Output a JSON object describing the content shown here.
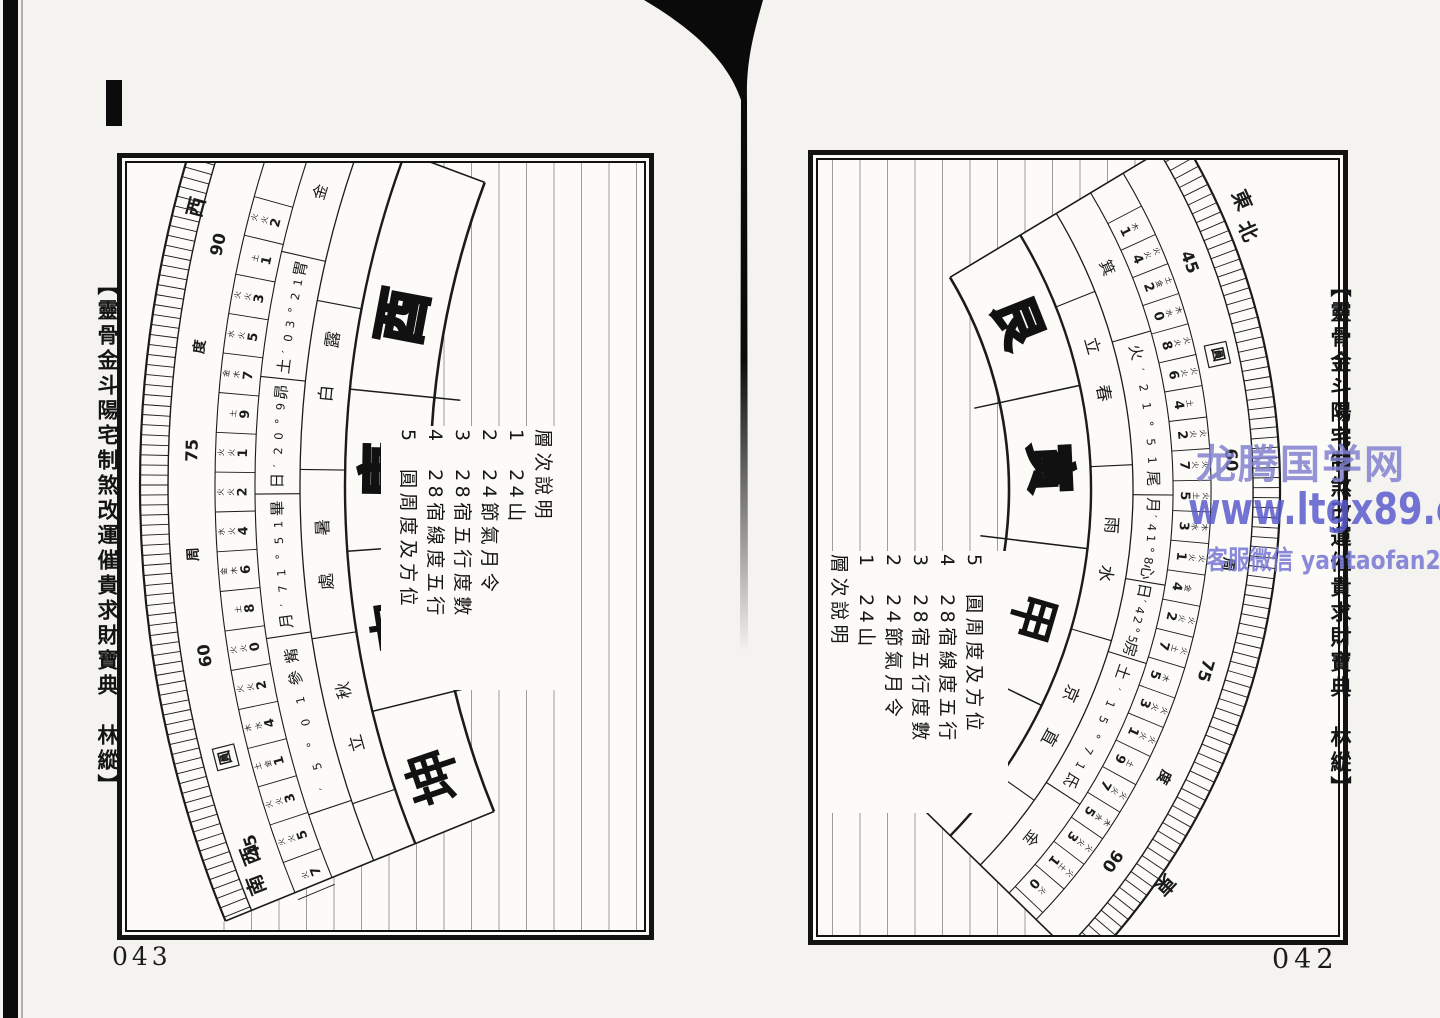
{
  "watermark": {
    "line1": "龙腾国学网",
    "line2": "www.ltgx89.com",
    "line3": "客服微信 yantaofan225",
    "color": "#6c6cc8"
  },
  "pages": [
    {
      "id": "left",
      "page_number": "043",
      "margin_title": "【靈骨金斗陽宅制煞改運催貴求財寶典　林縱】",
      "legend": {
        "title": "層次說明",
        "items": [
          "1　24山",
          "2　24節氣月令",
          "3　28宿五行度數",
          "4　28宿線度五行",
          "5　圓周度及方位"
        ]
      },
      "compass": {
        "direction_labels": [
          "西",
          "西南"
        ],
        "degree_ring": [
          "90",
          "度",
          "75",
          "周",
          "60",
          "圓",
          "45"
        ],
        "boxed_label": "圓",
        "mountains": [
          {
            "name": "酉",
            "style": "outline"
          },
          {
            "name": "庚",
            "style": "outline"
          },
          {
            "name": "申",
            "style": "solid"
          },
          {
            "name": "坤",
            "style": "solid"
          }
        ],
        "solar_terms": [
          {
            "upper": "露",
            "lower": "白"
          },
          {
            "upper": "暑",
            "lower": "處"
          },
          {
            "upper": "秋",
            "lower": "立"
          }
        ],
        "mansions": [
          "金",
          "胃12°30′土",
          "昴9°02′日",
          "畢15°17′月",
          "觜參10°5′"
        ],
        "line_degrees": [
          {
            "n": "2",
            "e": "火火"
          },
          {
            "n": "1",
            "e": "土"
          },
          {
            "n": "3",
            "e": "火火"
          },
          {
            "n": "5",
            "e": "火水"
          },
          {
            "n": "7",
            "e": "木金"
          },
          {
            "n": "9",
            "e": "土"
          },
          {
            "n": "1",
            "e": "火火"
          },
          {
            "n": "2",
            "e": "火火"
          },
          {
            "n": "4",
            "e": "火水"
          },
          {
            "n": "6",
            "e": "木金"
          },
          {
            "n": "8",
            "e": "土"
          },
          {
            "n": "0",
            "e": "火火"
          },
          {
            "n": "2",
            "e": "火火"
          },
          {
            "n": "4",
            "e": "水木"
          },
          {
            "n": "1",
            "e": "金土"
          },
          {
            "n": "3",
            "e": "火火"
          },
          {
            "n": "5",
            "e": "火火"
          },
          {
            "n": "7",
            "e": "火"
          }
        ]
      }
    },
    {
      "id": "right",
      "page_number": "042",
      "margin_title": "【靈骨金斗陽宅制煞改運催貴求財寶典　林縱】",
      "legend": {
        "title": "層次說明",
        "items": [
          "1　24山",
          "2　24節氣月令",
          "3　28宿五行度數",
          "4　28宿線度五行",
          "5　圓周度及方位"
        ]
      },
      "compass": {
        "direction_labels": [
          "東北",
          "東"
        ],
        "degree_ring": [
          "45",
          "圓",
          "60",
          "周",
          "75",
          "度",
          "90"
        ],
        "boxed_label": "圓",
        "mountains": [
          {
            "name": "艮",
            "style": "outline"
          },
          {
            "name": "寅",
            "style": "outline"
          },
          {
            "name": "甲",
            "style": "solid"
          },
          {
            "name": "卯",
            "style": "solid"
          }
        ],
        "solar_terms": [
          {
            "upper": "立",
            "lower": "春"
          },
          {
            "upper": "雨",
            "lower": "水"
          },
          {
            "upper": "京",
            "lower": "直"
          }
        ],
        "mansions": [
          "箕",
          "尾15°12′火",
          "心8°14′月",
          "房5°24′日",
          "氐17°51′土",
          "金"
        ],
        "line_degrees": [
          {
            "n": "1",
            "e": "木"
          },
          {
            "n": "4",
            "e": "火火"
          },
          {
            "n": "2",
            "e": "金土"
          },
          {
            "n": "0",
            "e": "水木"
          },
          {
            "n": "8",
            "e": "火火"
          },
          {
            "n": "6",
            "e": "火火"
          },
          {
            "n": "4",
            "e": "土"
          },
          {
            "n": "2",
            "e": "火火"
          },
          {
            "n": "7",
            "e": "火火"
          },
          {
            "n": "5",
            "e": "土火"
          },
          {
            "n": "3",
            "e": "水木"
          },
          {
            "n": "1",
            "e": "火火"
          },
          {
            "n": "4",
            "e": "金"
          },
          {
            "n": "2",
            "e": "火火"
          },
          {
            "n": "7",
            "e": "土火"
          },
          {
            "n": "5",
            "e": "木"
          },
          {
            "n": "3",
            "e": "火火"
          },
          {
            "n": "1",
            "e": "火火"
          },
          {
            "n": "9",
            "e": "土"
          },
          {
            "n": "7",
            "e": "火火"
          },
          {
            "n": "5",
            "e": "水木"
          },
          {
            "n": "3",
            "e": "火火"
          },
          {
            "n": "1",
            "e": "土火"
          },
          {
            "n": "0",
            "e": "火"
          }
        ]
      }
    }
  ]
}
